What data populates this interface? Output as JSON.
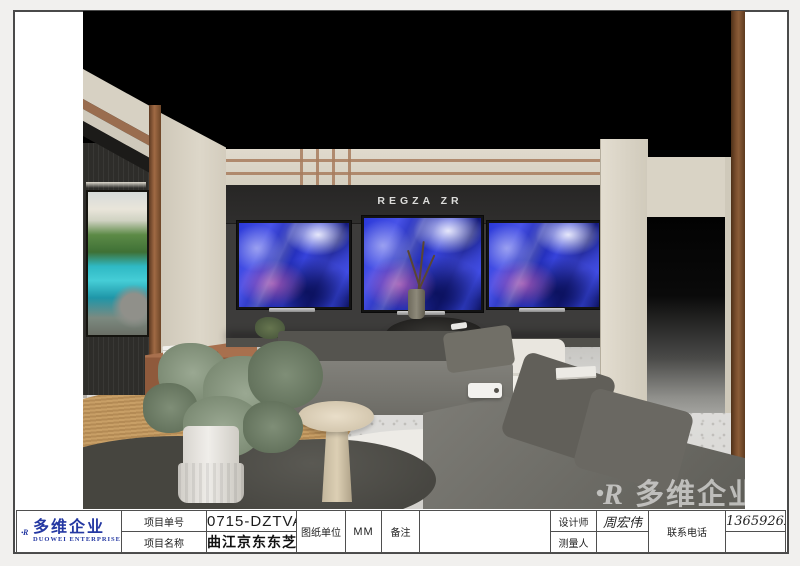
{
  "title_block": {
    "logo": {
      "company_cn": "多维企业",
      "company_en": "DUOWEI ENTERPRISE",
      "mark_letter": "R",
      "brand_color": "#2438a2"
    },
    "project_no_label": "项目单号",
    "project_no_value": "0715-DZTVA",
    "project_name_label": "项目名称",
    "project_name_value": "曲江京东东芝电视",
    "drawing_unit_label": "图纸单位",
    "drawing_unit_value": "MM",
    "remark_label": "备注",
    "remark_value": "",
    "designer_label": "设计师",
    "designer_value": "周宏伟",
    "surveyor_label": "测量人",
    "surveyor_value": "",
    "phone_label": "联系电话",
    "phone_value": "13659262305"
  },
  "scene": {
    "tv_brand_sign": "REGZA ZR",
    "watermark_cn": "多维企业",
    "watermark_mark": "R",
    "colors": {
      "wall_cream": "#dcd6c9",
      "tv_wall_dark": "#3c3b3b",
      "copper_trim": "#8a5c38",
      "tv_art_blue": "#2a38d8",
      "floor_terrazzo": "#dad9d5"
    }
  }
}
